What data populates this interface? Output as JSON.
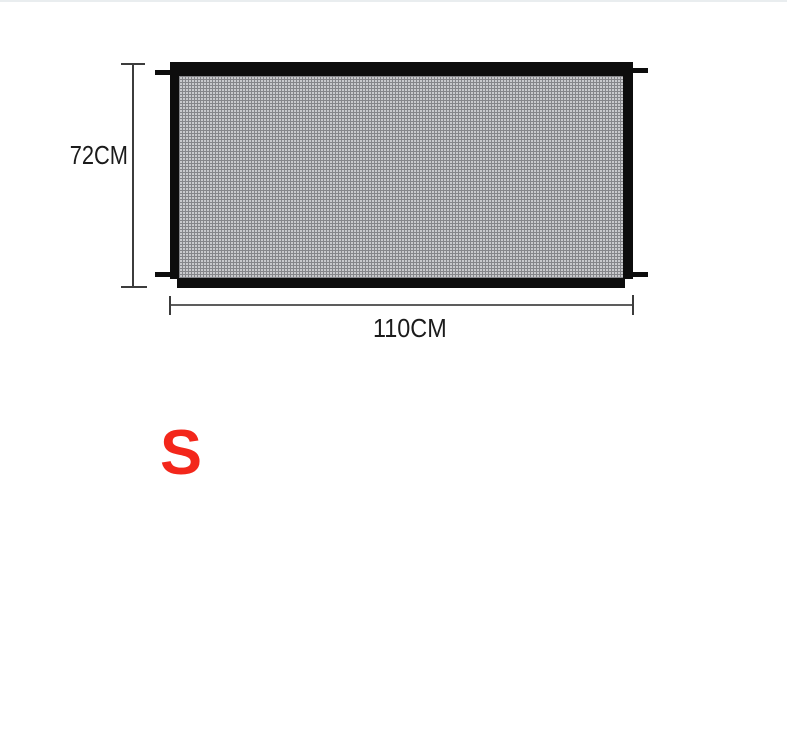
{
  "figure": {
    "type": "product-dimension-diagram",
    "product": "mesh-safety-gate",
    "height_label": "72CM",
    "width_label": "110CM",
    "size_label": "S",
    "colors": {
      "background": "#ffffff",
      "frame": "#0d0d0d",
      "mesh_light": "#c9cacd",
      "mesh_dark": "#85868a",
      "dimension_line": "#3c3c3c",
      "text": "#1b1b1b",
      "size_accent": "#f3271b"
    }
  }
}
